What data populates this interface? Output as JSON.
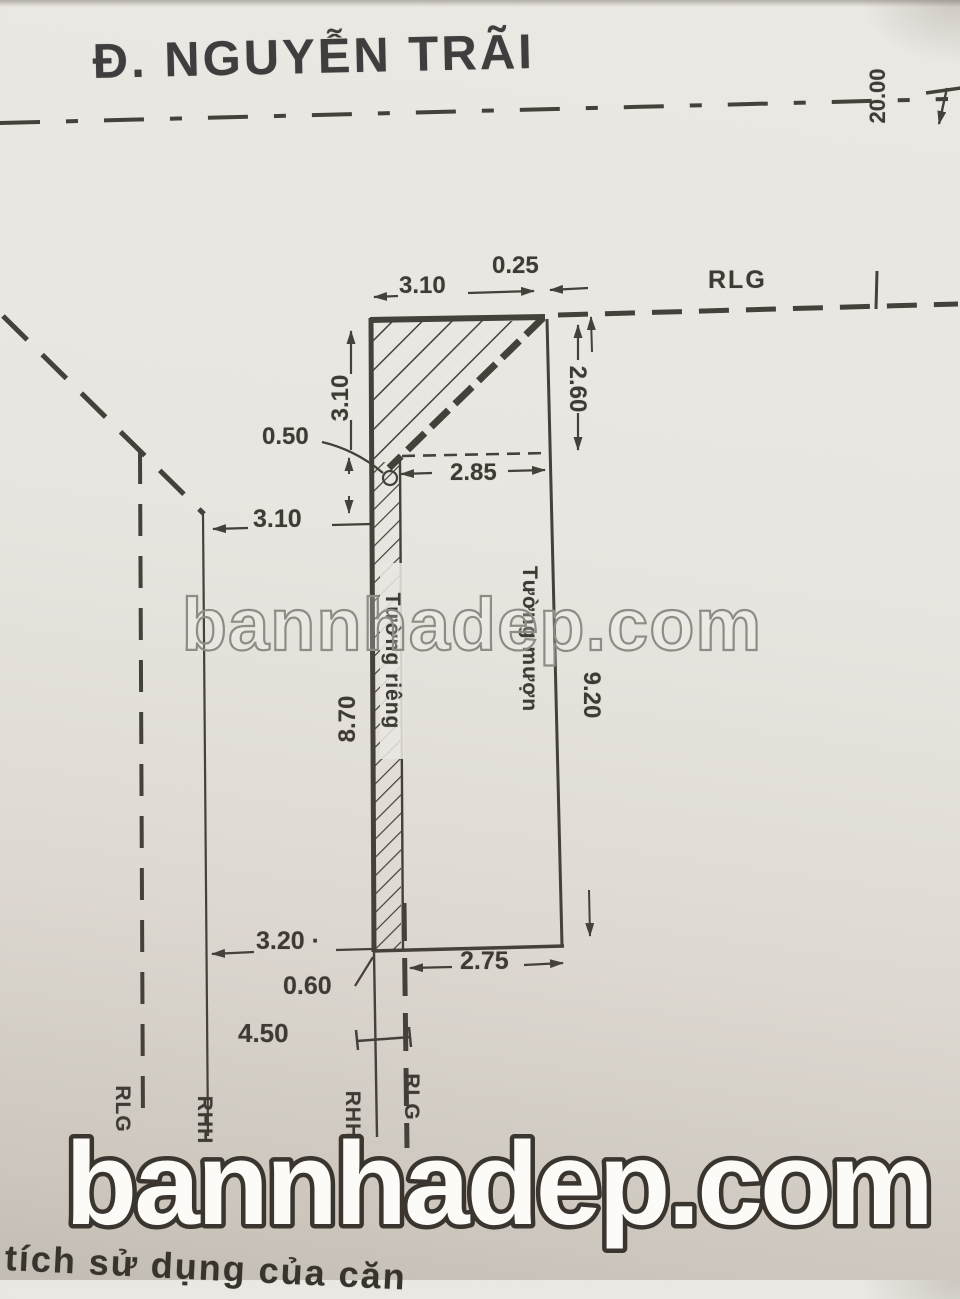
{
  "street": {
    "label": "Đ. NGUYỄN TRÃI",
    "width_dim": "20.00",
    "boundary_label": "RLG"
  },
  "parcel": {
    "dims": {
      "top_width": "3.10",
      "top_offset": "0.25",
      "triangle_height": "3.10",
      "setback": "0.50",
      "inner_width": "2.85",
      "right_upper": "2.60",
      "left_clearance": "3.10",
      "strip_length": "8.70",
      "right_length": "9.20",
      "rear_left": "3.20 ·",
      "strip_width": "0.60",
      "rear_width": "2.75",
      "rear_clearance": "4.50"
    },
    "walls": {
      "left": "Tường riêng",
      "right": "Tường mượn"
    }
  },
  "boundaries": {
    "bottom": [
      "RLG",
      "RHH",
      "RHH",
      "RLG"
    ]
  },
  "watermark": {
    "middle": "bannhadep.com",
    "bottom": "bannhadep.com"
  },
  "caption": {
    "partial_text": "tích sử dụng của căn"
  },
  "colors": {
    "ink": "#44403a",
    "paper": "#e9e6e1",
    "watermark_outline": "#8f8c85"
  }
}
